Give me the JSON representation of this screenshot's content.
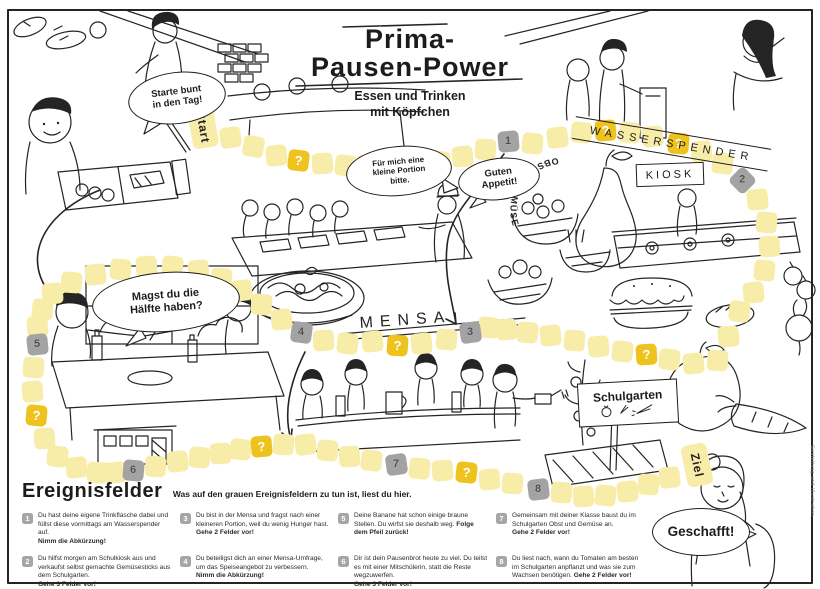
{
  "poster": {
    "title_line1": "Prima-",
    "title_line2": "Pausen-Power",
    "subtitle": "Essen und Trinken\nmit Köpfchen"
  },
  "signs": {
    "wasserspender": "WASSERSPENDER",
    "kiosk": "KIOSK",
    "obst_gemuese": "OBST & GEMÜSE",
    "mensa": "MENSA",
    "schulgarten": "Schulgarten"
  },
  "bubbles": {
    "starte_bunt": "Starte bunt\nin den Tag!",
    "kleine_portion": "Für mich eine\nkleine Portion\nbitte.",
    "guten_appetit": "Guten\nAppetit!",
    "haelfte": "Magst du die\nHälfte haben?",
    "geschafft": "Geschafft!"
  },
  "colors": {
    "path_tile": "#f8eca9",
    "question_tile": "#eec31d",
    "event_tile": "#a3a3a3"
  },
  "board": {
    "tiles": [
      [
        203,
        127,
        -10,
        "s",
        "Start"
      ],
      [
        230,
        137,
        -8,
        "p"
      ],
      [
        253,
        146,
        10,
        "p"
      ],
      [
        276,
        155,
        -6,
        "p"
      ],
      [
        298,
        160,
        7,
        "q",
        "?"
      ],
      [
        322,
        163,
        -4,
        "p"
      ],
      [
        345,
        165,
        6,
        "p"
      ],
      [
        368,
        164,
        -8,
        "p"
      ],
      [
        392,
        165,
        5,
        "q",
        "?"
      ],
      [
        416,
        166,
        -5,
        "p"
      ],
      [
        439,
        161,
        7,
        "p"
      ],
      [
        462,
        156,
        -6,
        "p"
      ],
      [
        485,
        149,
        4,
        "p"
      ],
      [
        508,
        141,
        -5,
        "e",
        "1"
      ],
      [
        532,
        143,
        6,
        "p"
      ],
      [
        557,
        137,
        -7,
        "p"
      ],
      [
        581,
        132,
        5,
        "p"
      ],
      [
        605,
        130,
        -4,
        "q",
        "?"
      ],
      [
        629,
        132,
        6,
        "p"
      ],
      [
        652,
        136,
        -6,
        "p"
      ],
      [
        678,
        143,
        4,
        "q",
        "?"
      ],
      [
        701,
        151,
        -5,
        "p"
      ],
      [
        722,
        163,
        8,
        "p"
      ],
      [
        742,
        180,
        45,
        "e",
        "2"
      ],
      [
        757,
        199,
        -6,
        "p"
      ],
      [
        766,
        222,
        5,
        "p"
      ],
      [
        769,
        246,
        -4,
        "p"
      ],
      [
        764,
        270,
        6,
        "p"
      ],
      [
        753,
        292,
        -5,
        "p"
      ],
      [
        739,
        311,
        7,
        "p"
      ],
      [
        728,
        336,
        -5,
        "p"
      ],
      [
        717,
        360,
        4,
        "p"
      ],
      [
        693,
        363,
        -6,
        "p"
      ],
      [
        669,
        359,
        5,
        "p"
      ],
      [
        646,
        354,
        -4,
        "q",
        "?"
      ],
      [
        622,
        351,
        6,
        "p"
      ],
      [
        598,
        346,
        -5,
        "p"
      ],
      [
        574,
        340,
        4,
        "p"
      ],
      [
        550,
        335,
        -6,
        "p"
      ],
      [
        527,
        332,
        5,
        "p"
      ],
      [
        506,
        329,
        -4,
        "p"
      ],
      [
        488,
        327,
        6,
        "p"
      ],
      [
        470,
        332,
        -8,
        "e",
        "3"
      ],
      [
        446,
        339,
        5,
        "p"
      ],
      [
        421,
        343,
        -6,
        "p"
      ],
      [
        397,
        345,
        4,
        "q",
        "?"
      ],
      [
        372,
        341,
        -5,
        "p"
      ],
      [
        347,
        343,
        6,
        "p"
      ],
      [
        323,
        340,
        -4,
        "p"
      ],
      [
        301,
        332,
        8,
        "e",
        "4"
      ],
      [
        281,
        319,
        -6,
        "p"
      ],
      [
        261,
        304,
        5,
        "p"
      ],
      [
        241,
        290,
        -7,
        "p"
      ],
      [
        221,
        278,
        4,
        "p"
      ],
      [
        198,
        270,
        -5,
        "p"
      ],
      [
        172,
        266,
        6,
        "p"
      ],
      [
        146,
        266,
        -4,
        "p"
      ],
      [
        120,
        269,
        5,
        "p"
      ],
      [
        95,
        274,
        -6,
        "p"
      ],
      [
        71,
        282,
        4,
        "p"
      ],
      [
        52,
        293,
        -5,
        "p"
      ],
      [
        42,
        309,
        6,
        "p"
      ],
      [
        37,
        326,
        -4,
        "p"
      ],
      [
        37,
        344,
        -6,
        "e",
        "5"
      ],
      [
        33,
        367,
        4,
        "p"
      ],
      [
        32,
        391,
        -5,
        "p"
      ],
      [
        36,
        415,
        5,
        "q",
        "?"
      ],
      [
        44,
        438,
        -4,
        "p"
      ],
      [
        57,
        456,
        6,
        "p"
      ],
      [
        76,
        467,
        -5,
        "p"
      ],
      [
        97,
        472,
        4,
        "p"
      ],
      [
        115,
        472,
        -6,
        "p"
      ],
      [
        133,
        470,
        5,
        "e",
        "6"
      ],
      [
        155,
        466,
        4,
        "p"
      ],
      [
        177,
        461,
        -6,
        "p"
      ],
      [
        199,
        457,
        5,
        "p"
      ],
      [
        220,
        453,
        -4,
        "p"
      ],
      [
        240,
        449,
        6,
        "p"
      ],
      [
        261,
        446,
        -5,
        "q",
        "?"
      ],
      [
        283,
        444,
        4,
        "p"
      ],
      [
        305,
        444,
        -6,
        "p"
      ],
      [
        327,
        450,
        5,
        "p"
      ],
      [
        349,
        456,
        -4,
        "p"
      ],
      [
        371,
        460,
        6,
        "p"
      ],
      [
        396,
        464,
        -8,
        "e",
        "7"
      ],
      [
        419,
        468,
        5,
        "p"
      ],
      [
        442,
        470,
        -4,
        "p"
      ],
      [
        466,
        472,
        6,
        "q",
        "?"
      ],
      [
        489,
        479,
        -5,
        "p"
      ],
      [
        512,
        483,
        4,
        "p"
      ],
      [
        538,
        489,
        -7,
        "e",
        "8"
      ],
      [
        561,
        492,
        5,
        "p"
      ],
      [
        583,
        496,
        -4,
        "p"
      ],
      [
        605,
        495,
        6,
        "p"
      ],
      [
        627,
        491,
        -5,
        "p"
      ],
      [
        648,
        484,
        4,
        "p"
      ],
      [
        669,
        477,
        -6,
        "p"
      ],
      [
        697,
        465,
        -12,
        "z",
        "Ziel"
      ]
    ]
  },
  "legend": {
    "heading": "Ereignisfelder",
    "intro": "Was auf den grauen Ereignisfeldern zu tun ist, liest du hier.",
    "items": [
      {
        "num": "1",
        "text": "Du hast deine eigene Trinkflasche dabei und füllst diese vormittags am Wasserspender auf.",
        "action": "Nimm die Abkürzung!"
      },
      {
        "num": "2",
        "text": "Du hilfst morgen am Schulkiosk aus und verkaufst selbst gemachte Gemüsesticks aus dem Schulgarten.",
        "action": "Gehe 3 Felder vor!"
      },
      {
        "num": "3",
        "text": "Du bist in der Mensa und fragst nach einer kleineren Portion, weil du wenig Hunger hast.",
        "action": "Gehe 2 Felder vor!"
      },
      {
        "num": "4",
        "text": "Du beteiligst dich an einer Mensa-Umfrage, um das Speiseangebot zu verbessern.",
        "action": "Nimm die Abkürzung!"
      },
      {
        "num": "5",
        "text": "Deine Banane hat schon einige braune Stellen. Du wirfst sie deshalb weg.",
        "action": "Folge dem Pfeil zurück!"
      },
      {
        "num": "6",
        "text": "Dir ist dein Pausenbrot heute zu viel. Du teilst es mit einer Mitschülerin, statt die Reste wegzuwerfen.",
        "action": "Gehe 3 Felder vor!"
      },
      {
        "num": "7",
        "text": "Gemeinsam mit deiner Klasse baust du im Schulgarten Obst und Gemüse an.",
        "action": "Gehe 2 Felder vor!"
      },
      {
        "num": "8",
        "text": "Du liest nach, wann du Tomaten am besten im Schulgarten anpflanzt und was sie zum Wachsen benötigen.",
        "action": "Gehe 2 Felder vor!"
      }
    ]
  },
  "credit": "Gestaltung und Illustration"
}
